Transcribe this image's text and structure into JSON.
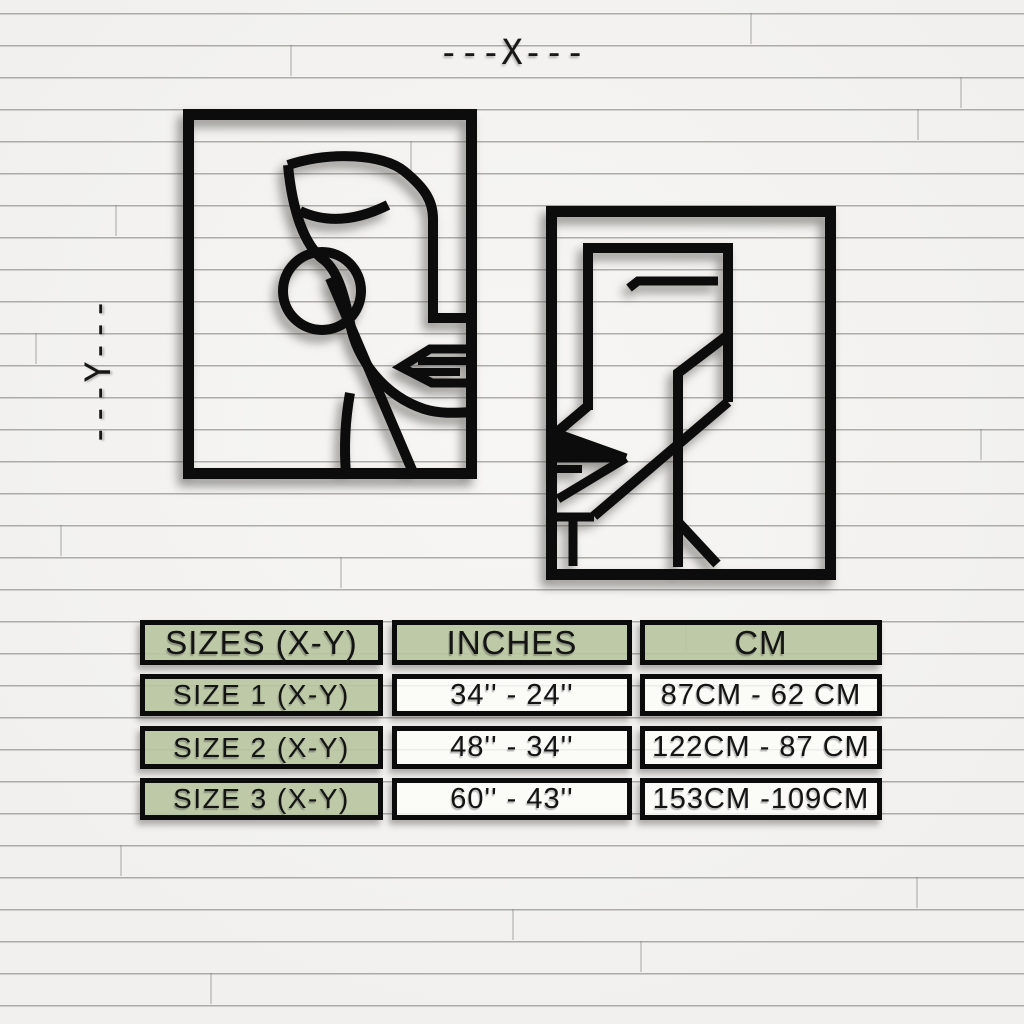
{
  "dimension_labels": {
    "x": "---X---",
    "y": "---Y---"
  },
  "artwork": {
    "left_panel": "abstract-face-line-art-panel",
    "right_panel": "abstract-face-line-art-panel"
  },
  "size_table": {
    "headers": [
      "SIZES (X-Y)",
      "INCHES",
      "CM"
    ],
    "rows": [
      {
        "size": "SIZE 1 (X-Y)",
        "inches": "34'' - 24''",
        "cm": "87CM - 62 CM"
      },
      {
        "size": "SIZE 2 (X-Y)",
        "inches": "48'' - 34''",
        "cm": "122CM - 87 CM"
      },
      {
        "size": "SIZE 3 (X-Y)",
        "inches": "60'' - 43''",
        "cm": "153CM -109CM"
      }
    ]
  },
  "colors": {
    "accent_green": "#b8c5a0",
    "line_black": "#0c0c0c",
    "wall_white": "#f3f2f0"
  }
}
